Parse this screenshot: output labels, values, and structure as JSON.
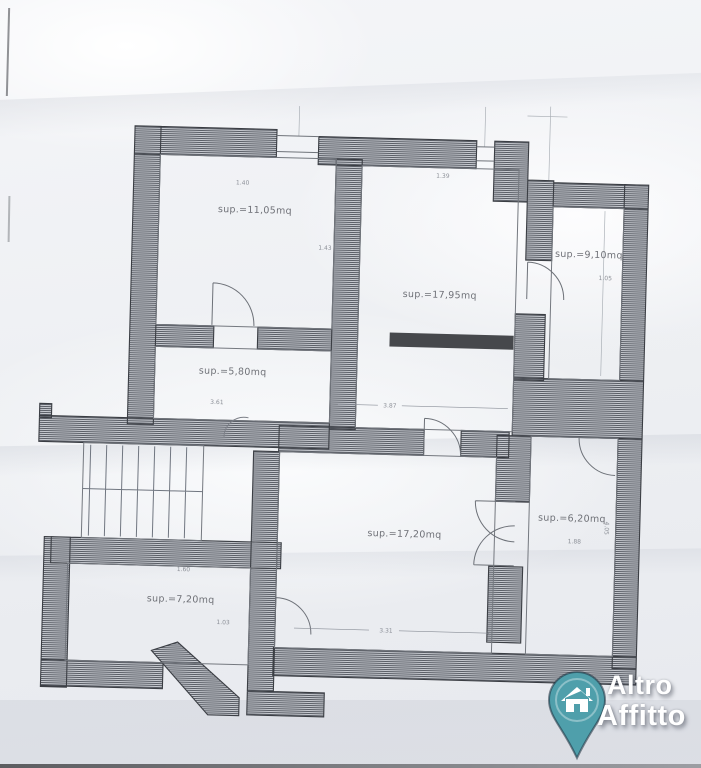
{
  "rooms": [
    {
      "label": "sup.=11,05mq"
    },
    {
      "label": "sup.=17,95mq"
    },
    {
      "label": "sup.=9,10mq"
    },
    {
      "label": "sup.=5,80mq"
    },
    {
      "label": "sup.=17,20mq"
    },
    {
      "label": "sup.=6,20mq"
    },
    {
      "label": "sup.=7,20mq"
    }
  ],
  "dimensions": [
    "1.40",
    "1.39",
    "1.43",
    "3.87",
    "1.05",
    "4.05",
    "1.88",
    "1.60",
    "3.31",
    "1.03",
    "3.61"
  ],
  "logo": {
    "line1": "Altro",
    "line2": "Affitto",
    "icon": "house-pin-icon",
    "pin_color": "#4f9fab"
  },
  "colors": {
    "paper": "#eef0f3",
    "wall_ink": "#3b3e44",
    "hatch_fill": "#c7cad0",
    "line_gray": "#6f737a",
    "accent_teal": "#4f9fab"
  }
}
